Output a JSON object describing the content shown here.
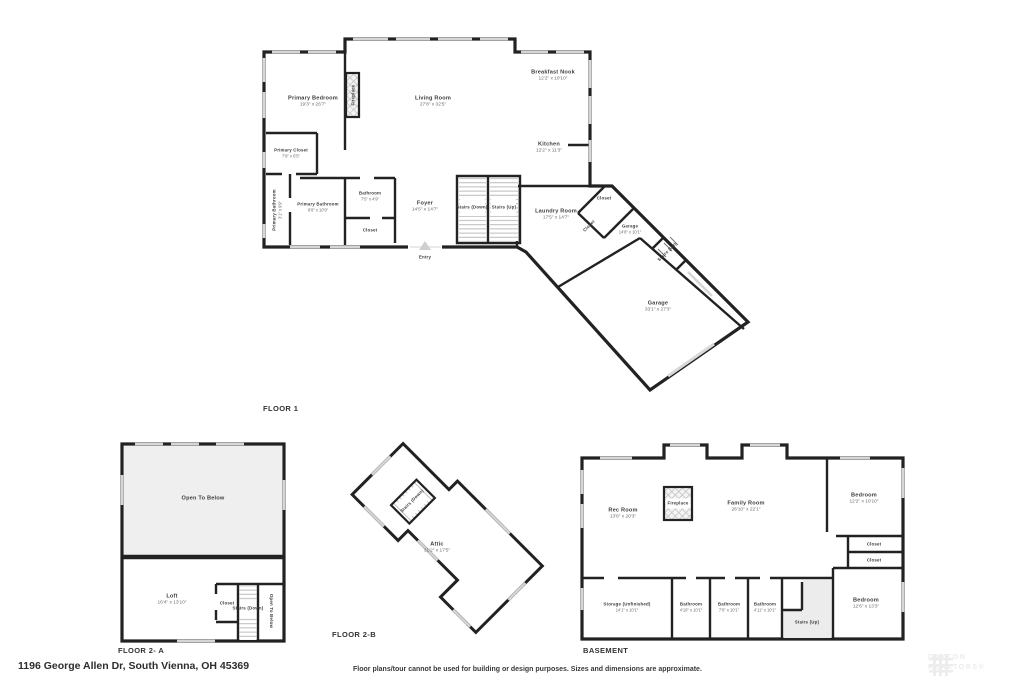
{
  "meta": {
    "address": "1196 George Allen Dr, South Vienna, OH 45369",
    "disclaimer": "Floor plans/tour cannot be used for building or design purposes. Sizes and dimensions are approximate.",
    "watermark_top": "DAYTON",
    "watermark_bottom": "REALTORS®"
  },
  "floor1": {
    "label": "FLOOR 1",
    "entry": "Entry",
    "rooms": {
      "primary_bedroom": {
        "name": "Primary Bedroom",
        "dims": "19'3\" x 26'7\""
      },
      "fireplace": {
        "name": "Fireplace"
      },
      "living_room": {
        "name": "Living Room",
        "dims": "27'8\" x 32'5\""
      },
      "breakfast_nook": {
        "name": "Breakfast Nook",
        "dims": "12'2\" x 10'10\""
      },
      "kitchen": {
        "name": "Kitchen",
        "dims": "12'2\" x 11'3\""
      },
      "primary_closet": {
        "name": "Primary Closet",
        "dims": "7'9\" x 6'5\""
      },
      "primary_bathroom_small": {
        "name": "Primary Bathroom",
        "dims": "3'1\" x 9'9\""
      },
      "primary_bathroom": {
        "name": "Primary Bathroom",
        "dims": "8'8\" x 10'9\""
      },
      "bathroom": {
        "name": "Bathroom",
        "dims": "7'5\" x 4'9\""
      },
      "closet": {
        "name": "Closet"
      },
      "foyer": {
        "name": "Foyer",
        "dims": "14'5\" x 14'7\""
      },
      "stairs_down": {
        "name": "Stairs (Down)"
      },
      "stairs_up": {
        "name": "Stairs (Up)"
      },
      "laundry": {
        "name": "Laundry Room",
        "dims": "17'5\" x 14'7\""
      },
      "closet_top": {
        "name": "Closet"
      },
      "closet_diag": {
        "name": "Closet"
      },
      "garage_small": {
        "name": "Garage",
        "dims": "14'8\" x 10'1\""
      },
      "stairs_up_small": {
        "name": "Stairs (Up)"
      },
      "garage": {
        "name": "Garage",
        "dims": "33'1\" x 27'3\""
      }
    }
  },
  "floor2a": {
    "label": "FLOOR 2- A",
    "rooms": {
      "open_to_below": {
        "name": "Open To Below"
      },
      "loft": {
        "name": "Loft",
        "dims": "16'4\" x 13'10\""
      },
      "closet": {
        "name": "Closet"
      },
      "stairs_down": {
        "name": "Stairs (Down)"
      },
      "open_to_below_side": {
        "name": "Open To Below"
      }
    }
  },
  "floor2b": {
    "label": "FLOOR 2-B",
    "rooms": {
      "attic": {
        "name": "Attic",
        "dims": "31'2\" x 17'5\""
      },
      "stairs_down": {
        "name": "Stairs (Down)"
      }
    }
  },
  "basement": {
    "label": "BASEMENT",
    "rooms": {
      "rec_room": {
        "name": "Rec Room",
        "dims": "13'6\" x 20'3\""
      },
      "fireplace": {
        "name": "Fireplace"
      },
      "family_room": {
        "name": "Family Room",
        "dims": "26'10\" x 22'1\""
      },
      "bedroom_top": {
        "name": "Bedroom",
        "dims": "12'2\" x 10'10\""
      },
      "closet1": {
        "name": "Closet"
      },
      "closet2": {
        "name": "Closet"
      },
      "bedroom_bottom": {
        "name": "Bedroom",
        "dims": "12'6\" x 13'3\""
      },
      "storage": {
        "name": "Storage (Unfinished)",
        "dims": "14'1\" x 10'1\""
      },
      "bathroom1": {
        "name": "Bathroom",
        "dims": "4'10\" x 10'1\""
      },
      "bathroom2": {
        "name": "Bathroom",
        "dims": "7'0\" x 10'1\""
      },
      "bathroom3": {
        "name": "Bathroom",
        "dims": "4'11\" x 10'1\""
      },
      "stairs_up": {
        "name": "Stairs (Up)"
      }
    }
  }
}
